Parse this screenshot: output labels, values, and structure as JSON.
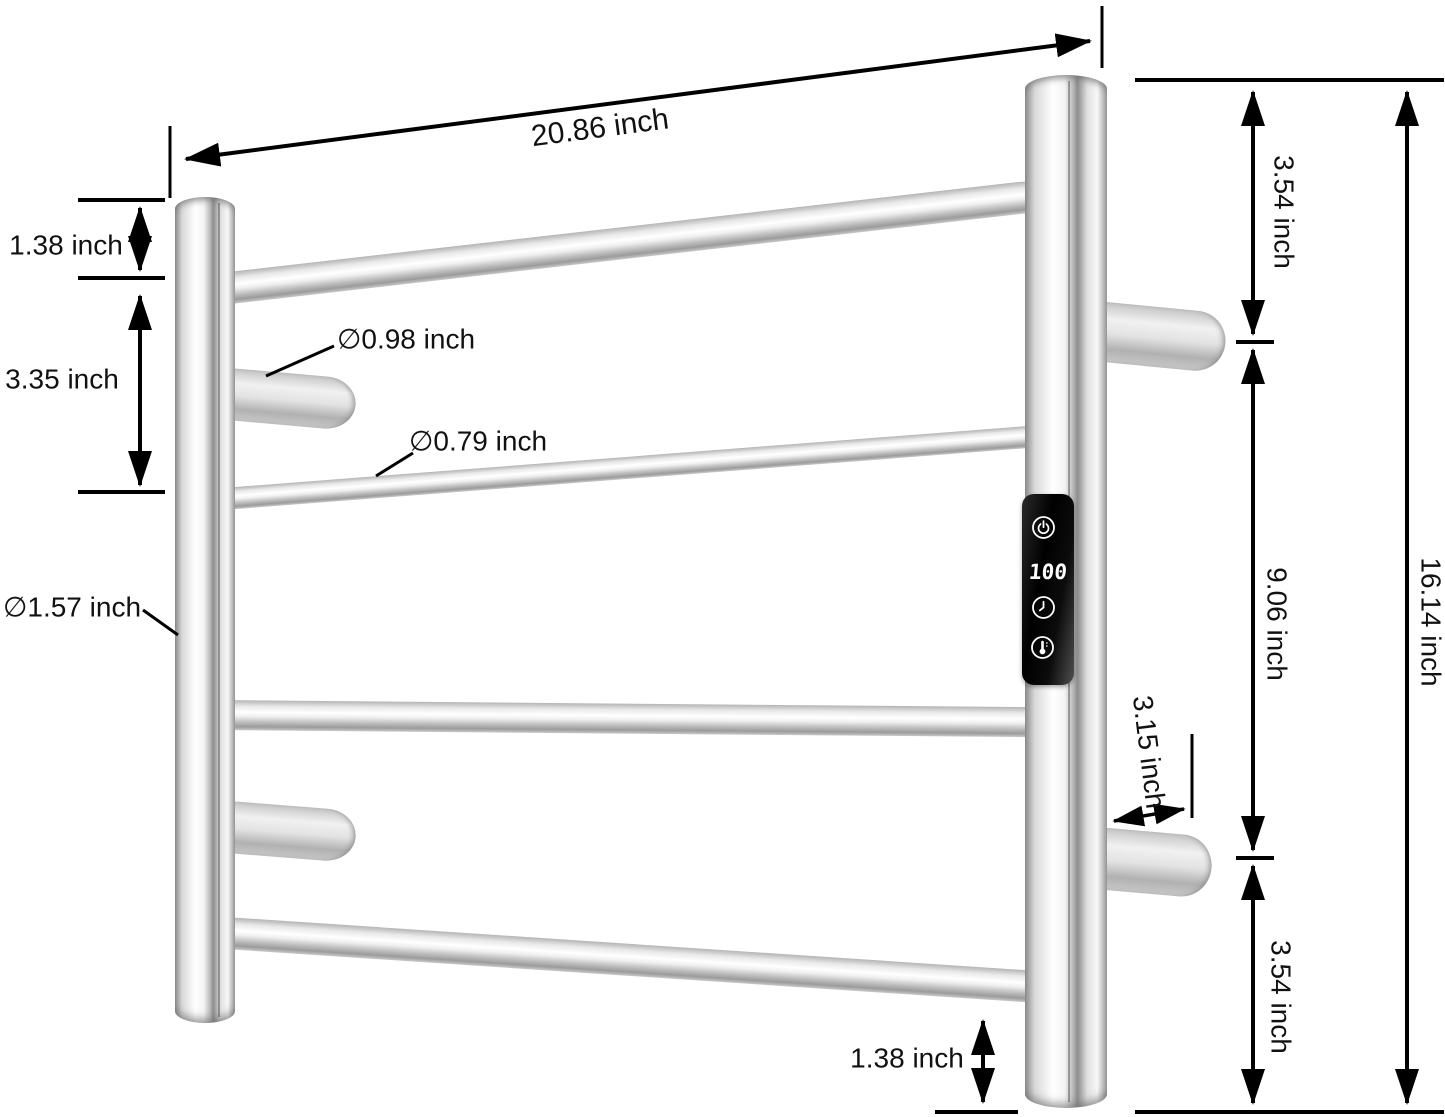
{
  "diagram": {
    "dimensions": {
      "top_width": "20.86 inch",
      "left_top_offset": "1.38 inch",
      "left_bar_spacing": "3.35 inch",
      "peg_diameter": "∅0.98 inch",
      "bar_diameter": "∅0.79 inch",
      "rail_diameter": "∅1.57 inch",
      "right_top_gap": "3.54 inch",
      "right_middle_span": "9.06 inch",
      "right_bottom_gap": "3.54 inch",
      "overall_height": "16.14 inch",
      "bracket_depth": "3.15 inch",
      "bottom_offset": "1.38 inch"
    },
    "control_panel": {
      "display_value": "100",
      "icons": [
        "power",
        "timer",
        "temperature"
      ]
    },
    "colors": {
      "dimension_line": "#000000",
      "panel_background": "#0a0a0a",
      "panel_foreground": "#ffffff",
      "metal_highlight": "#ffffff",
      "metal_shadow": "#8e8e8e",
      "background": "#ffffff"
    }
  }
}
